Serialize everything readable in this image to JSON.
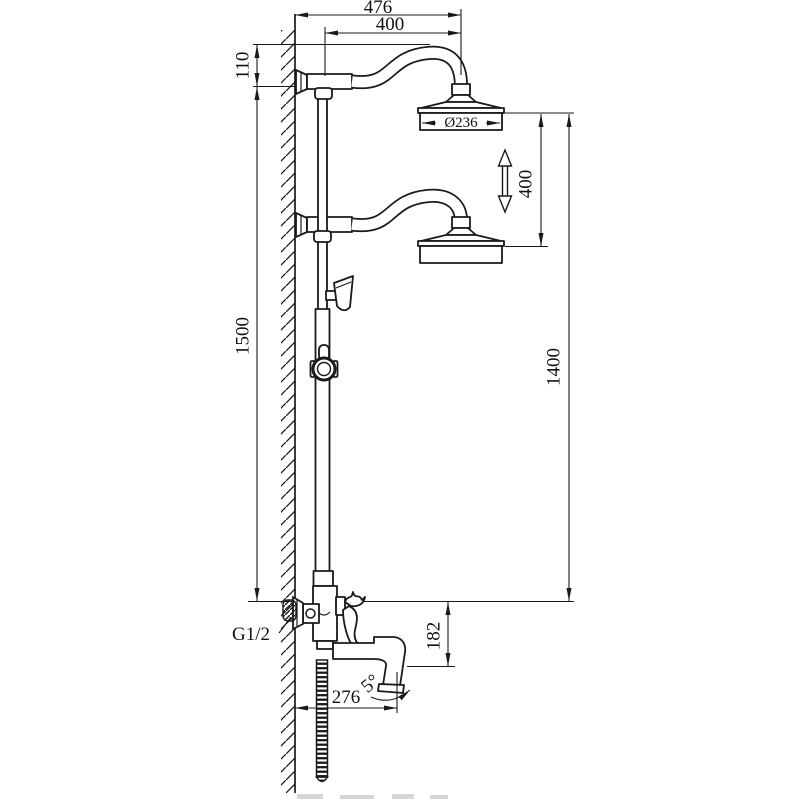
{
  "drawing": {
    "subject": "wall-mounted two-head shower column technical drawing",
    "units": "mm",
    "labels": {
      "d476": "476",
      "d400_top": "400",
      "d110": "110",
      "d236": "Ø236",
      "d400_adjust": "400",
      "d1500": "1500",
      "d1400": "1400",
      "d182": "182",
      "d276": "276",
      "d5": "5°",
      "g12": "G1/2"
    }
  }
}
